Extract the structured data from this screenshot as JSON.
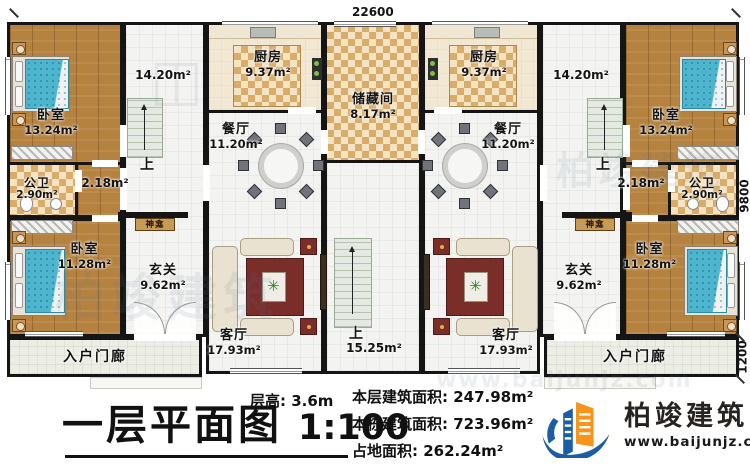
{
  "meta": {
    "title": "一层平面图",
    "scale": "1:100"
  },
  "dimensions": {
    "top_width": "22600",
    "right_upper": "9800",
    "right_lower": "1200"
  },
  "rooms": {
    "bedroom_tl": {
      "name": "卧室",
      "area": "13.24m²"
    },
    "bedroom_tr": {
      "name": "卧室",
      "area": "13.24m²"
    },
    "bedroom_bl": {
      "name": "卧室",
      "area": "11.28m²"
    },
    "bedroom_br": {
      "name": "卧室",
      "area": "11.28m²"
    },
    "bath_l": {
      "name": "公卫",
      "area": "2.90m²"
    },
    "bath_r": {
      "name": "公卫",
      "area": "2.90m²"
    },
    "hall_area_l": "14.20m²",
    "hall_area_r": "14.20m²",
    "corridor_l": "2.18m²",
    "corridor_r": "2.18m²",
    "kitchen_l": {
      "name": "厨房",
      "area": "9.37m²"
    },
    "kitchen_r": {
      "name": "厨房",
      "area": "9.37m²"
    },
    "dining_l": {
      "name": "餐厅",
      "area": "11.20m²"
    },
    "dining_r": {
      "name": "餐厅",
      "area": "11.20m²"
    },
    "storage": {
      "name": "储藏间",
      "area": "8.17m²"
    },
    "living_l": {
      "name": "客厅",
      "area": "17.93m²"
    },
    "living_r": {
      "name": "客厅",
      "area": "17.93m²"
    },
    "foyer_l": {
      "name": "玄关",
      "area": "9.62m²"
    },
    "foyer_r": {
      "name": "玄关",
      "area": "9.62m²"
    },
    "porch_l": {
      "name": "入户门廊"
    },
    "porch_r": {
      "name": "入户门廊"
    },
    "shrine_l": "神龛",
    "shrine_r": "神龛",
    "stair_up_l": "上",
    "stair_up_r": "上",
    "stair_center": {
      "label": "上",
      "area": "15.25m²"
    }
  },
  "stats": {
    "floor_height_label": "层高:",
    "floor_height": "3.6m",
    "floor_area_label": "本层建筑面积:",
    "floor_area": "247.98m²",
    "building_area_label": "本栋建筑面积:",
    "building_area": "723.96m²",
    "footprint_label": "占地面积:",
    "footprint": "262.24m²"
  },
  "brand": {
    "name": "柏竣建筑",
    "url": "www.baijunjz.com"
  },
  "watermark": {
    "text": "柏竣建筑",
    "url": "www.baijunjz.com"
  },
  "colors": {
    "wall": "#151515",
    "wood_floor": "#b5823f",
    "tile_floor": "#f3f3f1",
    "checker_dark": "#d9ac6a",
    "checker_light": "#f4e4c4",
    "bed_blue": "#4db6ce",
    "rug_red": "#7b2d2a",
    "sofa_cream": "#e9e2d0",
    "stair_green": "#e4eae1",
    "logo_blue": "#1b5ea6",
    "logo_orange": "#f7941d"
  }
}
